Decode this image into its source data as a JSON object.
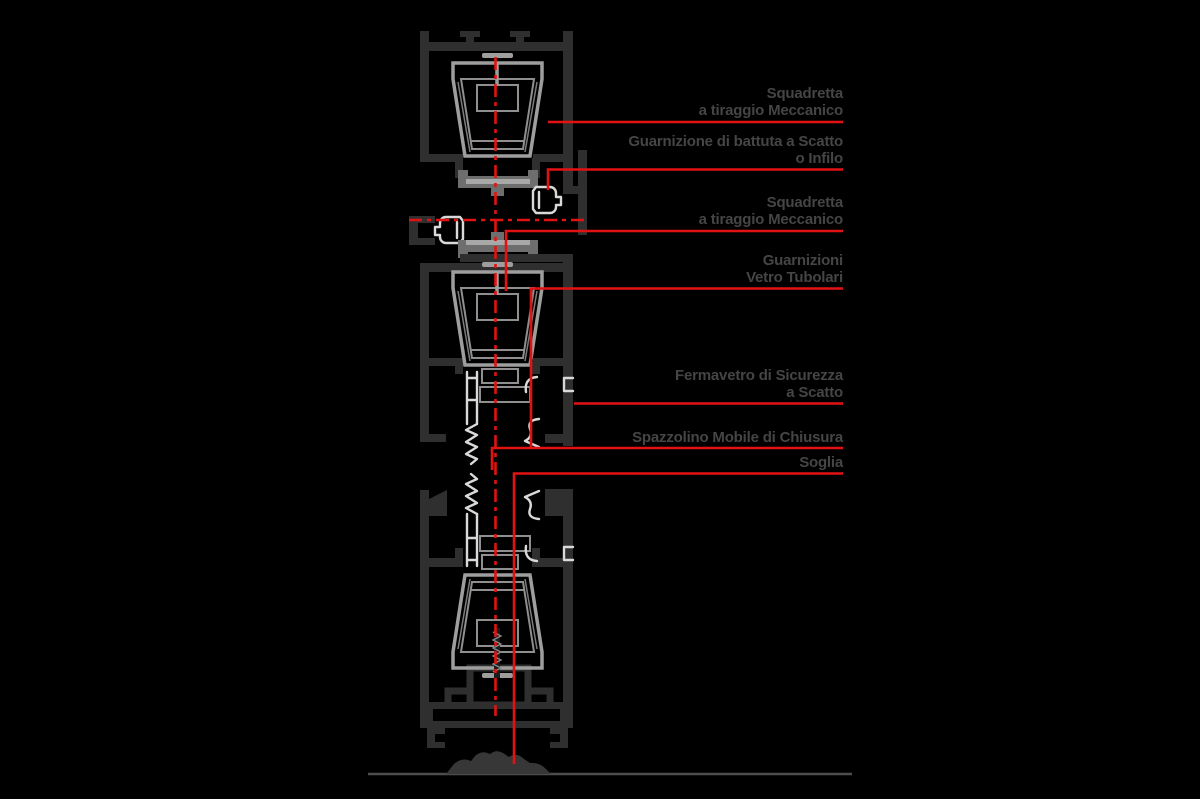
{
  "diagram": {
    "kind": "technical-cross-section",
    "subject": "vertical section of a minimal-frame sliding window system with component callouts",
    "language": "it"
  },
  "colors": {
    "bg": "#000000",
    "profile": "#2f2f2f",
    "bracket": "#9e9e9e",
    "gasket": "#d9d9d9",
    "accent-red": "#e21212",
    "label-text": "#454545",
    "floor": "#4d4d4d"
  },
  "labels": [
    {
      "id": "squadretta-top",
      "lines": [
        "Squadretta",
        "a tiraggio Meccanico"
      ]
    },
    {
      "id": "guarnizione-battuta",
      "lines": [
        "Guarnizione di battuta a Scatto",
        "o Infilo"
      ]
    },
    {
      "id": "squadretta-middle",
      "lines": [
        "Squadretta",
        "a tiraggio Meccanico"
      ]
    },
    {
      "id": "guarnizioni-vetro",
      "lines": [
        "Guarnizioni",
        "Vetro Tubolari"
      ]
    },
    {
      "id": "fermavetro",
      "lines": [
        "Fermavetro di Sicurezza",
        "a Scatto"
      ]
    },
    {
      "id": "spazzolino",
      "lines": [
        "Spazzolino Mobile di Chiusura"
      ]
    },
    {
      "id": "soglia",
      "lines": [
        "Soglia"
      ]
    }
  ]
}
